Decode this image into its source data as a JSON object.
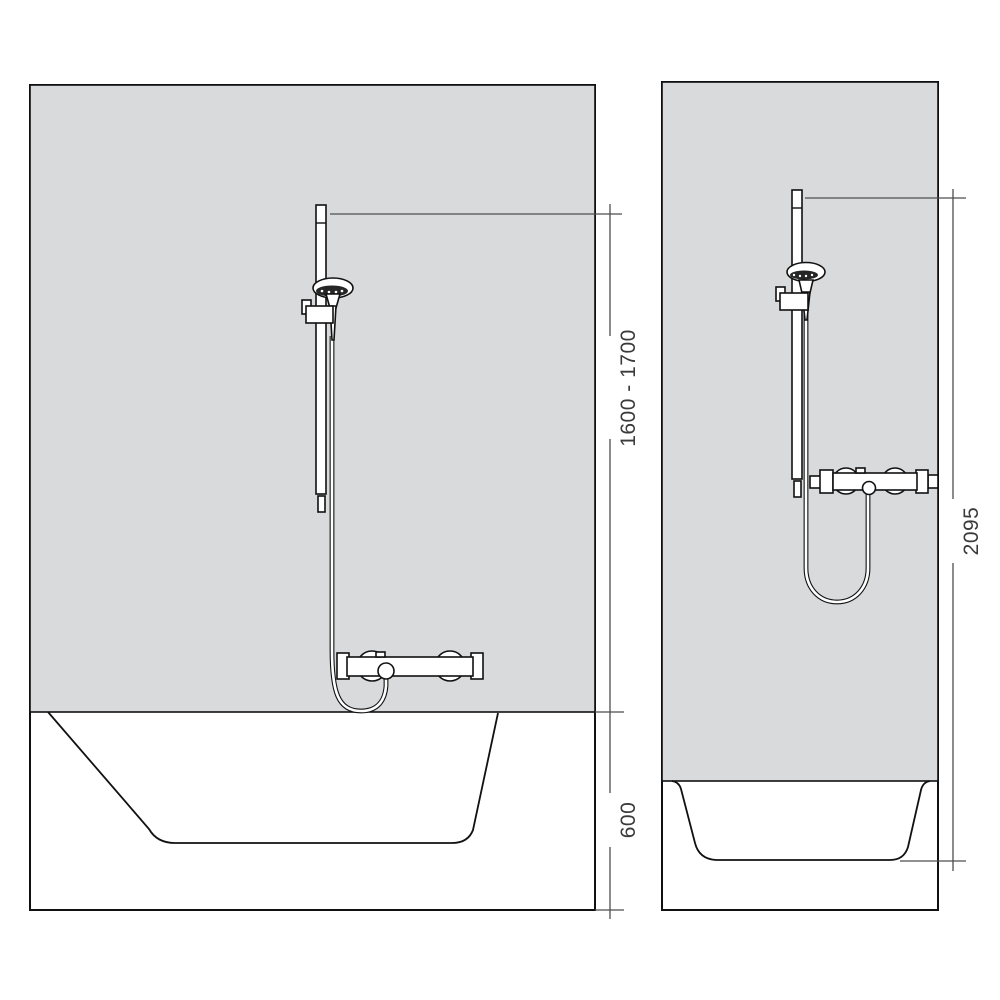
{
  "dimensions": {
    "front_bar_height": "1600 - 1700",
    "front_tub_height": "600",
    "side_overall_height": "2095"
  },
  "colors": {
    "background": "#ffffff",
    "wall-fill": "#d8dadb",
    "outline": "#111111",
    "dim-line": "#4d4d4d",
    "dim-text": "#3a3a3a",
    "spray-face": "#262626"
  }
}
